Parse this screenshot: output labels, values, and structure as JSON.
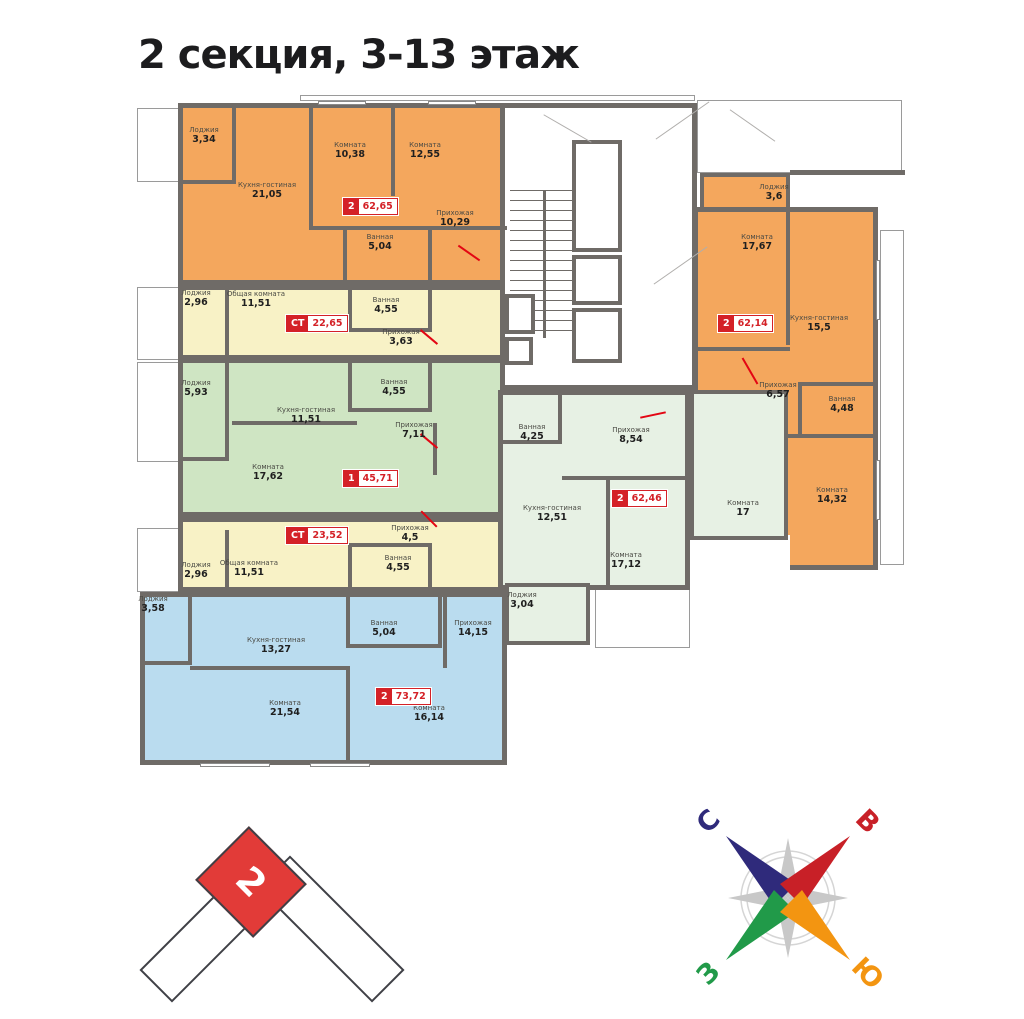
{
  "page": {
    "title": "2 секция, 3-13 этаж"
  },
  "locator": {
    "section_label": "2"
  },
  "compass": {
    "north": {
      "label": "С",
      "color": "#2F2A7B"
    },
    "east": {
      "label": "В",
      "color": "#C82027"
    },
    "west": {
      "label": "З",
      "color": "#219A49"
    },
    "south": {
      "label": "Ю",
      "color": "#F39511"
    }
  },
  "wall_color": "#6F6B67",
  "apartments": [
    {
      "key": "apt-2room-62-65",
      "badge": {
        "type": "2",
        "area": "62,65"
      },
      "color": "#F4A75D",
      "rooms": [
        {
          "name": "Лоджия",
          "area": "3,34"
        },
        {
          "name": "Кухня-гостиная",
          "area": "21,05"
        },
        {
          "name": "Комната",
          "area": "10,38"
        },
        {
          "name": "Комната",
          "area": "12,55"
        },
        {
          "name": "Ванная",
          "area": "5,04"
        },
        {
          "name": "Прихожая",
          "area": "10,29"
        }
      ]
    },
    {
      "key": "apt-studio-22-65",
      "badge": {
        "type": "СТ",
        "area": "22,65"
      },
      "color": "#F8F2C6",
      "rooms": [
        {
          "name": "Лоджия",
          "area": "2,96"
        },
        {
          "name": "Общая комната",
          "area": "11,51"
        },
        {
          "name": "Ванная",
          "area": "4,55"
        },
        {
          "name": "Прихожая",
          "area": "3,63"
        }
      ]
    },
    {
      "key": "apt-1room-45-71",
      "badge": {
        "type": "1",
        "area": "45,71"
      },
      "color": "#CFE5C3",
      "rooms": [
        {
          "name": "Лоджия",
          "area": "5,93"
        },
        {
          "name": "Кухня-гостиная",
          "area": "11,51"
        },
        {
          "name": "Ванная",
          "area": "4,55"
        },
        {
          "name": "Прихожая",
          "area": "7,11"
        },
        {
          "name": "Комната",
          "area": "17,62"
        }
      ]
    },
    {
      "key": "apt-studio-23-52",
      "badge": {
        "type": "СТ",
        "area": "23,52"
      },
      "color": "#F8F2C6",
      "rooms": [
        {
          "name": "Лоджия",
          "area": "2,96"
        },
        {
          "name": "Общая комната",
          "area": "11,51"
        },
        {
          "name": "Прихожая",
          "area": "4,5"
        },
        {
          "name": "Ванная",
          "area": "4,55"
        }
      ]
    },
    {
      "key": "apt-2room-73-72",
      "badge": {
        "type": "2",
        "area": "73,72"
      },
      "color": "#BADCEF",
      "rooms": [
        {
          "name": "Лоджия",
          "area": "3,58"
        },
        {
          "name": "Кухня-гостиная",
          "area": "13,27"
        },
        {
          "name": "Ванная",
          "area": "5,04"
        },
        {
          "name": "Прихожая",
          "area": "14,15"
        },
        {
          "name": "Комната",
          "area": "21,54"
        },
        {
          "name": "Комната",
          "area": "16,14"
        }
      ]
    },
    {
      "key": "apt-2room-62-46",
      "badge": {
        "type": "2",
        "area": "62,46"
      },
      "color": "#E7F1E4",
      "rooms": [
        {
          "name": "Ванная",
          "area": "4,25"
        },
        {
          "name": "Прихожая",
          "area": "8,54"
        },
        {
          "name": "Кухня-гостиная",
          "area": "12,51"
        },
        {
          "name": "Комната",
          "area": "17,12"
        },
        {
          "name": "Комната",
          "area": "17"
        },
        {
          "name": "Лоджия",
          "area": "3,04"
        }
      ]
    },
    {
      "key": "apt-2room-62-14",
      "badge": {
        "type": "2",
        "area": "62,14"
      },
      "color": "#F4A75D",
      "rooms": [
        {
          "name": "Лоджия",
          "area": "3,6"
        },
        {
          "name": "Комната",
          "area": "17,67"
        },
        {
          "name": "Кухня-гостиная",
          "area": "15,5"
        },
        {
          "name": "Прихожая",
          "area": "6,57"
        },
        {
          "name": "Ванная",
          "area": "4,48"
        },
        {
          "name": "Комната",
          "area": "14,32"
        }
      ]
    }
  ]
}
